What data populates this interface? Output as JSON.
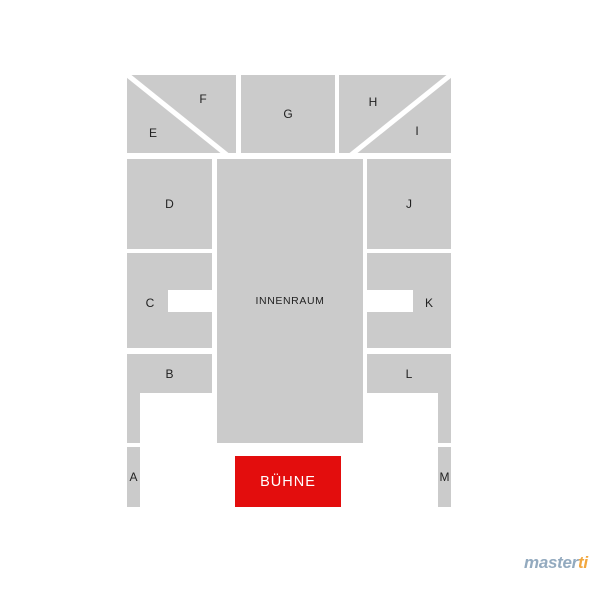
{
  "page": {
    "background": "#ffffff"
  },
  "seatmap": {
    "sections": {
      "A": "A",
      "B": "B",
      "C": "C",
      "D": "D",
      "E": "E",
      "F": "F",
      "G": "G",
      "H": "H",
      "I": "I",
      "J": "J",
      "K": "K",
      "L": "L",
      "M": "M"
    },
    "innenraum_label": "INNENRAUM",
    "stage_label": "BÜHNE",
    "colors": {
      "section_fill": "#cbcbcb",
      "section_label": "#222222",
      "stage_fill": "#e30d0d",
      "stage_label": "#ffffff",
      "divider": "#ffffff"
    }
  },
  "branding": {
    "logo_text_primary": "master",
    "logo_text_accent": "ti",
    "logo_primary_color": "#93aabf",
    "logo_accent_color": "#f2a73e"
  }
}
